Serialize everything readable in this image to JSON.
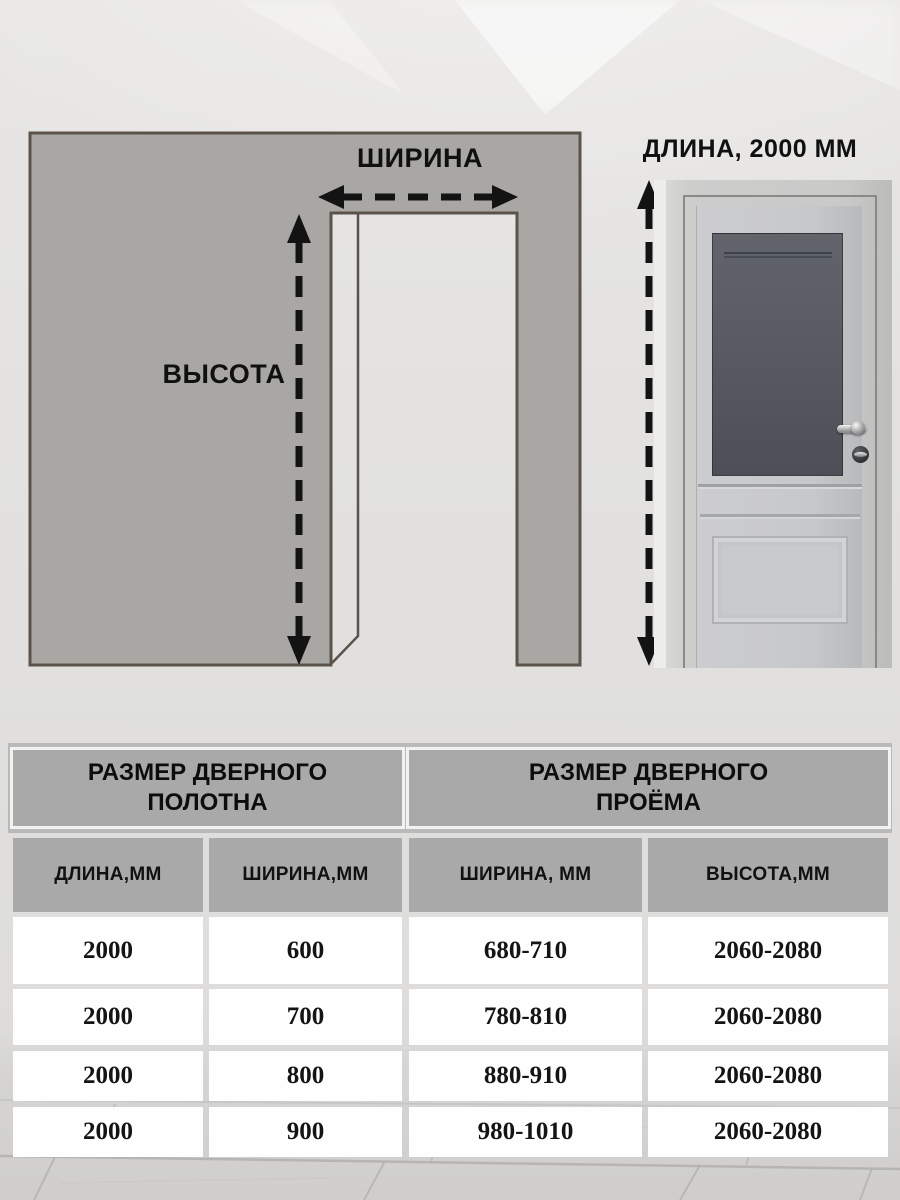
{
  "diagram": {
    "width_label": "ШИРИНА",
    "height_label": "ВЫСОТА",
    "door_length_label": "ДЛИНА, 2000 ММ"
  },
  "table": {
    "group_headers": [
      "РАЗМЕР ДВЕРНОГО ПОЛОТНА",
      "РАЗМЕР ДВЕРНОГО ПРОЁМА"
    ],
    "columns": [
      "ДЛИНА,ММ",
      "ШИРИНА,ММ",
      "ШИРИНА, ММ",
      "ВЫСОТА,ММ"
    ],
    "rows": [
      [
        "2000",
        "600",
        "680-710",
        "2060-2080"
      ],
      [
        "2000",
        "700",
        "780-810",
        "2060-2080"
      ],
      [
        "2000",
        "800",
        "880-910",
        "2060-2080"
      ],
      [
        "2000",
        "900",
        "980-1010",
        "2060-2080"
      ]
    ]
  },
  "colors": {
    "wall_fill": "#a9a7a3",
    "wall_stroke": "#5b5349",
    "arrow": "#131313",
    "header_gray": "#a9a9a9",
    "header_backdrop": "#b9b9b9",
    "row_white": "#fefefe",
    "glass_gray": "#565a60",
    "floor_gray": "#d5d4d2"
  }
}
